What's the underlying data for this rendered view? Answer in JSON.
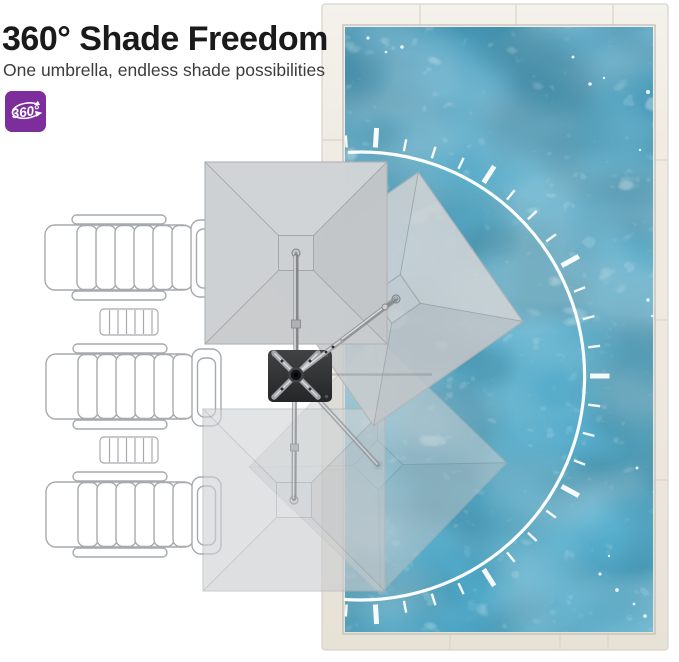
{
  "header": {
    "title": "360° Shade Freedom",
    "subtitle": "One umbrella, endless shade possibilities"
  },
  "badge": {
    "label": "360°",
    "icon": "rotation-360-icon"
  },
  "colors": {
    "badge_purple": "#7d2d9c",
    "title_ink": "#1a1a1a",
    "subtitle_ink": "#3c3c3c",
    "water_base": "#55aac8",
    "deck_cream": "#ece7dd",
    "canopy_gray": "#cbced0",
    "base_charcoal": "#2e3032",
    "arc_white": "#ffffff",
    "chair_outline": "#a6aaae"
  }
}
